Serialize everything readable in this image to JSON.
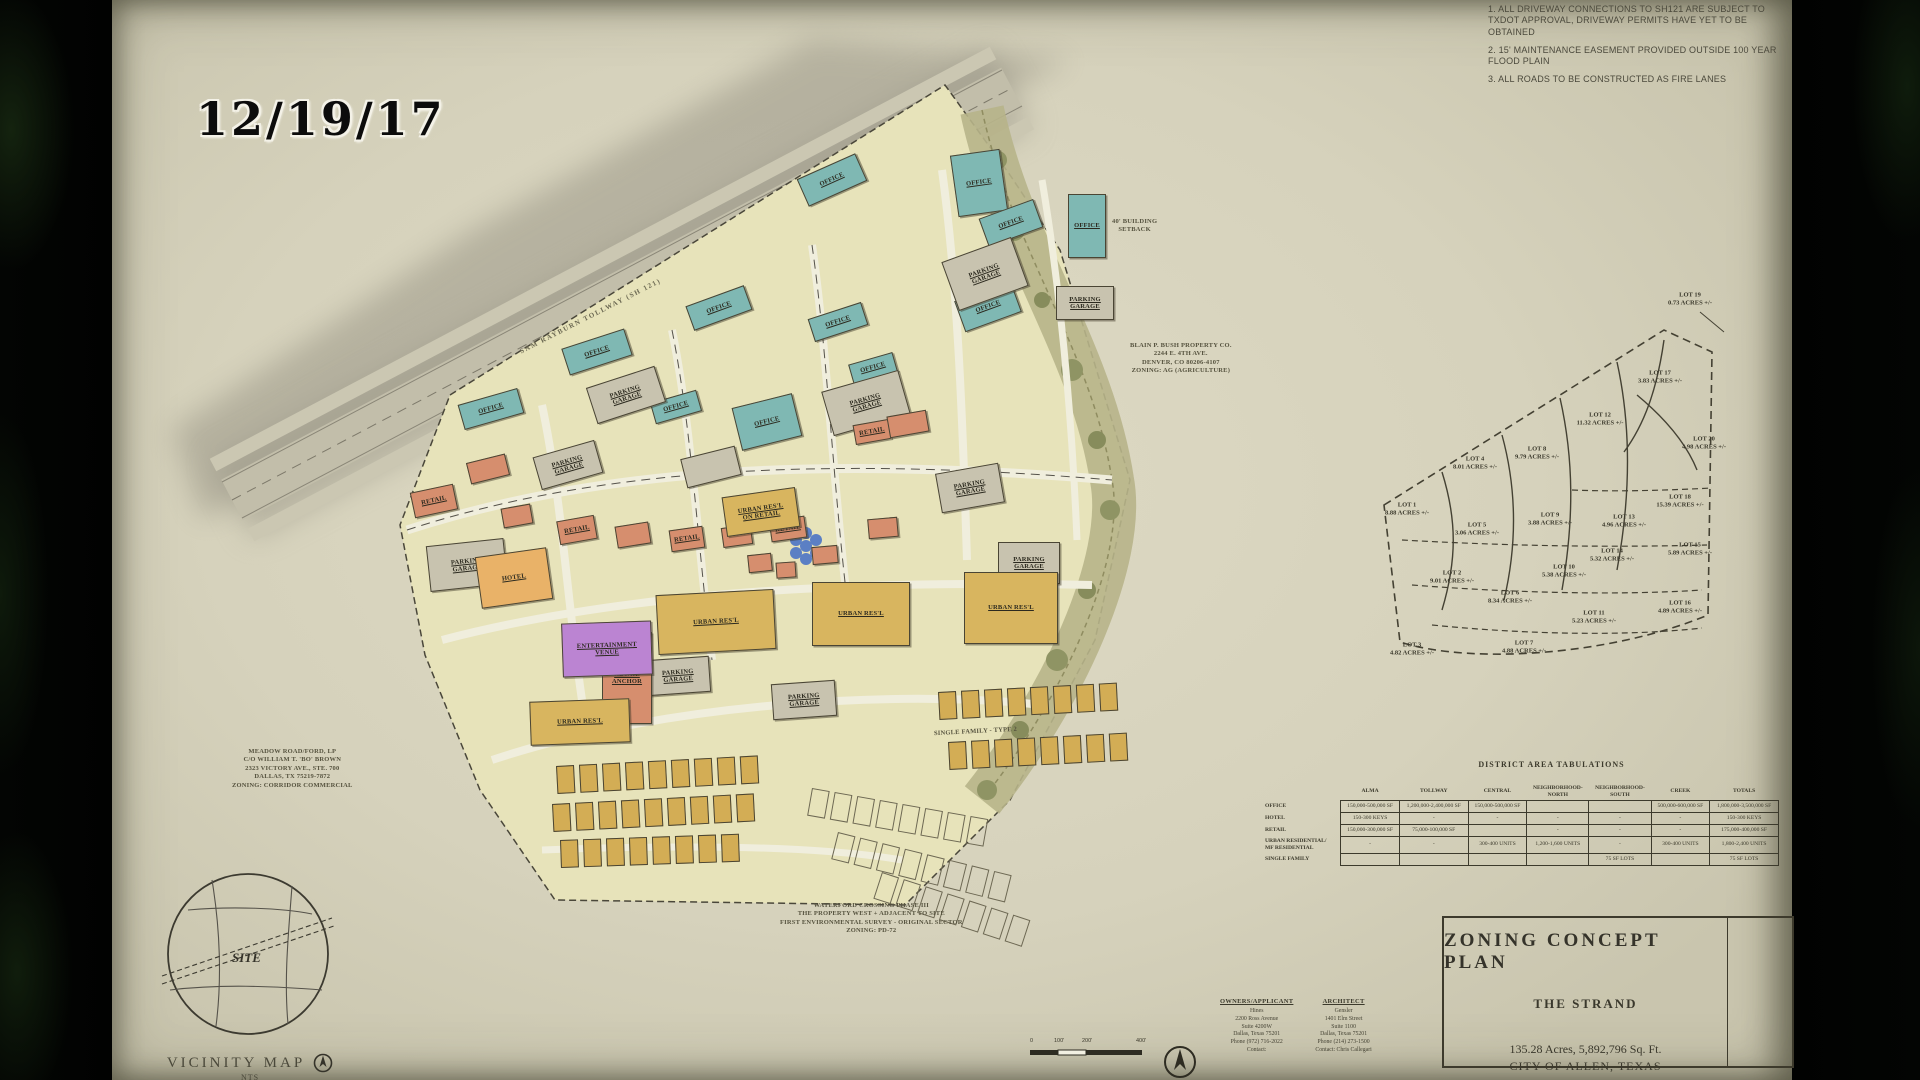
{
  "overlay": {
    "date_stamp": "12/19/17"
  },
  "notes": [
    "1.  ALL DRIVEWAY CONNECTIONS TO SH121 ARE SUBJECT TO TXDOT APPROVAL, DRIVEWAY PERMITS HAVE YET TO BE OBTAINED",
    "2.  15' MAINTENANCE EASEMENT PROVIDED OUTSIDE 100 YEAR FLOOD PLAIN",
    "3.  ALL ROADS TO BE CONSTRUCTED AS FIRE LANES"
  ],
  "title_block": {
    "line1": "ZONING CONCEPT PLAN",
    "line2": "THE STRAND",
    "line3": "135.28 Acres, 5,892,796 Sq. Ft.",
    "line4": "CITY OF ALLEN, TEXAS"
  },
  "vicinity": {
    "title": "VICINITY MAP",
    "scale": "NTS",
    "site_label": "SITE"
  },
  "scale_bar": {
    "labels": [
      "0",
      "100'",
      "200'",
      "400'"
    ],
    "ratio": "1\"=200.0'"
  },
  "contacts": {
    "owners": {
      "heading": "OWNERS/APPLICANT",
      "lines": [
        "Hines",
        "2200 Ross Avenue",
        "Suite 4200W",
        "Dallas, Texas 75201",
        "Phone (972) 716-2022",
        "Contact:"
      ]
    },
    "architect": {
      "heading": "ARCHITECT",
      "lines": [
        "Gensler",
        "1401 Elm Street",
        "Suite 1100",
        "Dallas, Texas 75201",
        "Phone (214) 273-1500",
        "Contact: Chris Callegari"
      ]
    }
  },
  "annotations": [
    {
      "id": "tollway-name",
      "text": "SAM RAYBURN TOLLWAY (SH 121)",
      "x": 400,
      "y": 312,
      "rot": -27,
      "cls": "road"
    },
    {
      "id": "setback-note",
      "text": "40' BUILDING\nSETBACK",
      "x": 1000,
      "y": 218,
      "rot": 0
    },
    {
      "id": "bush-property",
      "text": "BLAIN P. BUSH PROPERTY CO.\n2244 E. 4TH AVE.\nDENVER, CO 80206-4107\nZONING: AG (AGRICULTURE)",
      "x": 1018,
      "y": 342,
      "rot": 0
    },
    {
      "id": "meadow-property",
      "text": "MEADOW ROAD/FORD, LP\nC/O WILLIAM T. 'BO' BROWN\n2323 VICTORY AVE., STE. 700\nDALLAS, TX 75219-7872\nZONING: CORRIDOR COMMERCIAL",
      "x": 120,
      "y": 748,
      "rot": 0
    },
    {
      "id": "waterford-note",
      "text": "WATERFORD CROSSING PHASE III\nTHE PROPERTY WEST + ADJACENT TO SITE\nFIRST ENVIRONMENTAL SURVEY - ORIGINAL SECTOR\nZONING: PD-72",
      "x": 668,
      "y": 902,
      "rot": 0
    },
    {
      "id": "single-family-label",
      "text": "SINGLE FAMILY - TYPE 2",
      "x": 822,
      "y": 728,
      "rot": -3
    }
  ],
  "site": {
    "buildings": [
      {
        "x": 688,
        "y": 165,
        "w": 64,
        "h": 30,
        "r": -24,
        "label": "OFFICE",
        "type": "office"
      },
      {
        "x": 842,
        "y": 152,
        "w": 50,
        "h": 62,
        "r": -8,
        "label": "OFFICE",
        "type": "office"
      },
      {
        "x": 956,
        "y": 194,
        "w": 38,
        "h": 64,
        "r": 0,
        "label": "OFFICE",
        "type": "office"
      },
      {
        "x": 870,
        "y": 208,
        "w": 58,
        "h": 30,
        "r": -20,
        "label": "OFFICE",
        "type": "office"
      },
      {
        "x": 846,
        "y": 290,
        "w": 60,
        "h": 33,
        "r": -20,
        "label": "OFFICE",
        "type": "office"
      },
      {
        "x": 576,
        "y": 295,
        "w": 62,
        "h": 26,
        "r": -20,
        "label": "OFFICE",
        "type": "office"
      },
      {
        "x": 698,
        "y": 310,
        "w": 56,
        "h": 24,
        "r": -18,
        "label": "OFFICE",
        "type": "office"
      },
      {
        "x": 452,
        "y": 338,
        "w": 66,
        "h": 28,
        "r": -18,
        "label": "OFFICE",
        "type": "office"
      },
      {
        "x": 348,
        "y": 396,
        "w": 62,
        "h": 26,
        "r": -16,
        "label": "OFFICE",
        "type": "office"
      },
      {
        "x": 540,
        "y": 396,
        "w": 48,
        "h": 22,
        "r": -16,
        "label": "OFFICE",
        "type": "office"
      },
      {
        "x": 624,
        "y": 400,
        "w": 62,
        "h": 44,
        "r": -14,
        "label": "OFFICE",
        "type": "office"
      },
      {
        "x": 738,
        "y": 358,
        "w": 46,
        "h": 20,
        "r": -16,
        "label": "OFFICE",
        "type": "office"
      },
      {
        "x": 836,
        "y": 248,
        "w": 74,
        "h": 52,
        "r": -20,
        "label": "PARKING\nGARAGE",
        "type": "garage"
      },
      {
        "x": 944,
        "y": 286,
        "w": 58,
        "h": 34,
        "r": 0,
        "label": "PARKING\nGARAGE",
        "type": "garage"
      },
      {
        "x": 714,
        "y": 380,
        "w": 80,
        "h": 46,
        "r": -16,
        "label": "PARKING\nGARAGE",
        "type": "garage"
      },
      {
        "x": 478,
        "y": 376,
        "w": 72,
        "h": 38,
        "r": -18,
        "label": "PARKING\nGARAGE",
        "type": "garage"
      },
      {
        "x": 424,
        "y": 448,
        "w": 64,
        "h": 34,
        "r": -16,
        "label": "PARKING\nGARAGE",
        "type": "garage"
      },
      {
        "x": 316,
        "y": 542,
        "w": 78,
        "h": 46,
        "r": -6,
        "label": "PARKING\nGARAGE",
        "type": "garage"
      },
      {
        "x": 826,
        "y": 468,
        "w": 64,
        "h": 40,
        "r": -10,
        "label": "PARKING\nGARAGE",
        "type": "garage"
      },
      {
        "x": 886,
        "y": 542,
        "w": 62,
        "h": 42,
        "r": 0,
        "label": "PARKING\nGARAGE",
        "type": "garage"
      },
      {
        "x": 534,
        "y": 658,
        "w": 64,
        "h": 36,
        "r": -4,
        "label": "PARKING\nGARAGE",
        "type": "garage"
      },
      {
        "x": 660,
        "y": 682,
        "w": 64,
        "h": 36,
        "r": -4,
        "label": "PARKING\nGARAGE",
        "type": "garage"
      },
      {
        "x": 571,
        "y": 452,
        "w": 56,
        "h": 30,
        "r": -14,
        "label": "",
        "type": "garage"
      },
      {
        "x": 300,
        "y": 488,
        "w": 44,
        "h": 26,
        "r": -12,
        "label": "RETAIL",
        "type": "retail"
      },
      {
        "x": 356,
        "y": 458,
        "w": 40,
        "h": 22,
        "r": -14,
        "label": "",
        "type": "retail"
      },
      {
        "x": 390,
        "y": 506,
        "w": 30,
        "h": 20,
        "r": -10,
        "label": "",
        "type": "retail"
      },
      {
        "x": 446,
        "y": 518,
        "w": 38,
        "h": 24,
        "r": -10,
        "label": "RETAIL",
        "type": "retail"
      },
      {
        "x": 504,
        "y": 524,
        "w": 34,
        "h": 22,
        "r": -9,
        "label": "",
        "type": "retail"
      },
      {
        "x": 558,
        "y": 528,
        "w": 34,
        "h": 22,
        "r": -8,
        "label": "RETAIL",
        "type": "retail"
      },
      {
        "x": 610,
        "y": 526,
        "w": 30,
        "h": 20,
        "r": -8,
        "label": "",
        "type": "retail"
      },
      {
        "x": 658,
        "y": 518,
        "w": 36,
        "h": 22,
        "r": -8,
        "label": "RETAIL",
        "type": "retail"
      },
      {
        "x": 700,
        "y": 546,
        "w": 26,
        "h": 18,
        "r": -5,
        "label": "",
        "type": "retail"
      },
      {
        "x": 756,
        "y": 518,
        "w": 30,
        "h": 20,
        "r": -5,
        "label": "",
        "type": "retail"
      },
      {
        "x": 742,
        "y": 422,
        "w": 36,
        "h": 20,
        "r": -10,
        "label": "RETAIL",
        "type": "retail"
      },
      {
        "x": 776,
        "y": 413,
        "w": 40,
        "h": 22,
        "r": -10,
        "label": "",
        "type": "retail"
      },
      {
        "x": 636,
        "y": 554,
        "w": 24,
        "h": 18,
        "r": -6,
        "label": "",
        "type": "retail"
      },
      {
        "x": 664,
        "y": 562,
        "w": 20,
        "h": 16,
        "r": -4,
        "label": "",
        "type": "retail"
      },
      {
        "x": 612,
        "y": 492,
        "w": 74,
        "h": 40,
        "r": -8,
        "label": "URBAN RES'L\nON RETAIL",
        "type": "urban"
      },
      {
        "x": 490,
        "y": 632,
        "w": 50,
        "h": 92,
        "r": 0,
        "label": "RETAIL\nANCHOR",
        "type": "retail"
      },
      {
        "x": 366,
        "y": 552,
        "w": 72,
        "h": 52,
        "r": -8,
        "label": "HOTEL",
        "type": "hotel"
      },
      {
        "x": 450,
        "y": 622,
        "w": 90,
        "h": 54,
        "r": -2,
        "label": "ENTERTAINMENT\nVENUE",
        "type": "venue"
      },
      {
        "x": 545,
        "y": 592,
        "w": 118,
        "h": 60,
        "r": -3,
        "label": "URBAN RES'L",
        "type": "urban"
      },
      {
        "x": 700,
        "y": 582,
        "w": 98,
        "h": 64,
        "r": 0,
        "label": "URBAN RES'L",
        "type": "urban"
      },
      {
        "x": 852,
        "y": 572,
        "w": 94,
        "h": 72,
        "r": 0,
        "label": "URBAN RES'L",
        "type": "urban"
      },
      {
        "x": 418,
        "y": 700,
        "w": 100,
        "h": 44,
        "r": -2,
        "label": "URBAN RES'L",
        "type": "urban"
      }
    ],
    "sf_rows": [
      {
        "x": 826,
        "y": 692,
        "n": 8,
        "r": -3,
        "type": "sf"
      },
      {
        "x": 836,
        "y": 742,
        "n": 8,
        "r": -3,
        "type": "sf"
      },
      {
        "x": 444,
        "y": 766,
        "n": 9,
        "r": -3,
        "type": "sf"
      },
      {
        "x": 440,
        "y": 804,
        "n": 9,
        "r": -3,
        "type": "sf"
      },
      {
        "x": 448,
        "y": 840,
        "n": 8,
        "r": -2,
        "type": "sf"
      },
      {
        "x": 700,
        "y": 788,
        "n": 8,
        "r": 10,
        "type": "lot"
      },
      {
        "x": 726,
        "y": 832,
        "n": 8,
        "r": 14,
        "type": "lot"
      },
      {
        "x": 770,
        "y": 872,
        "n": 7,
        "r": 18,
        "type": "lot"
      }
    ]
  },
  "lot_diagram": {
    "lots": [
      {
        "name": "LOT 19",
        "acres": "0.73 ACRES +/-",
        "x": 1578,
        "y": 300
      },
      {
        "name": "LOT 17",
        "acres": "3.83 ACRES +/-",
        "x": 1548,
        "y": 378
      },
      {
        "name": "LOT 12",
        "acres": "11.32 ACRES +/-",
        "x": 1488,
        "y": 420
      },
      {
        "name": "LOT 20",
        "acres": "4.98 ACRES +/-",
        "x": 1592,
        "y": 444
      },
      {
        "name": "LOT 8",
        "acres": "9.79 ACRES +/-",
        "x": 1425,
        "y": 454
      },
      {
        "name": "LOT 4",
        "acres": "8.01 ACRES +/-",
        "x": 1363,
        "y": 464
      },
      {
        "name": "LOT 18",
        "acres": "15.39 ACRES +/-",
        "x": 1568,
        "y": 502
      },
      {
        "name": "LOT 1",
        "acres": "8.88 ACRES +/-",
        "x": 1295,
        "y": 510
      },
      {
        "name": "LOT 5",
        "acres": "3.06 ACRES +/-",
        "x": 1365,
        "y": 530
      },
      {
        "name": "LOT 9",
        "acres": "3.88 ACRES +/-",
        "x": 1438,
        "y": 520
      },
      {
        "name": "LOT 13",
        "acres": "4.96 ACRES +/-",
        "x": 1512,
        "y": 522
      },
      {
        "name": "LOT 14",
        "acres": "5.32 ACRES +/-",
        "x": 1500,
        "y": 556
      },
      {
        "name": "LOT 15",
        "acres": "5.89 ACRES +/-",
        "x": 1578,
        "y": 550
      },
      {
        "name": "LOT 2",
        "acres": "9.01 ACRES +/-",
        "x": 1340,
        "y": 578
      },
      {
        "name": "LOT 6",
        "acres": "8.34 ACRES +/-",
        "x": 1398,
        "y": 598
      },
      {
        "name": "LOT 10",
        "acres": "5.38 ACRES +/-",
        "x": 1452,
        "y": 572
      },
      {
        "name": "LOT 11",
        "acres": "5.23 ACRES +/-",
        "x": 1482,
        "y": 618
      },
      {
        "name": "LOT 16",
        "acres": "4.89 ACRES +/-",
        "x": 1568,
        "y": 608
      },
      {
        "name": "LOT 3",
        "acres": "4.82 ACRES +/-",
        "x": 1300,
        "y": 650
      },
      {
        "name": "LOT 7",
        "acres": "4.88 ACRES +/-",
        "x": 1412,
        "y": 648
      }
    ]
  },
  "table": {
    "title": "DISTRICT AREA TABULATIONS",
    "columns": [
      "",
      "ALMA",
      "TOLLWAY",
      "CENTRAL",
      "NEIGHBORHOOD-\nNORTH",
      "NEIGHBORHOOD-\nSOUTH",
      "CREEK",
      "TOTALS"
    ],
    "rows": [
      {
        "label": "OFFICE",
        "cells": [
          "150,000-500,000 SF",
          "1,200,000-2,400,000 SF",
          "150,000-500,000 SF",
          "",
          "",
          "500,000-600,000 SF",
          "1,800,000-3,500,000 SF"
        ]
      },
      {
        "label": "HOTEL",
        "cells": [
          "150-300 KEYS",
          "-",
          "-",
          "-",
          "-",
          "-",
          "150-300 KEYS"
        ]
      },
      {
        "label": "RETAIL",
        "cells": [
          "150,000-300,000 SF",
          "75,000-100,000 SF",
          "",
          "-",
          "-",
          "-",
          "175,000-400,000 SF"
        ]
      },
      {
        "label": "URBAN RESIDENTIAL/\nMF RESIDENTIAL",
        "cells": [
          "-",
          "-",
          "300-400 UNITS",
          "1,200-1,600 UNITS",
          "-",
          "300-400 UNITS",
          "1,800-2,400 UNITS"
        ]
      },
      {
        "label": "SINGLE FAMILY",
        "cells": [
          "",
          "",
          "",
          "",
          "75 SF LOTS",
          "",
          "75 SF LOTS"
        ]
      }
    ]
  },
  "colors": {
    "office": "#7fb8b3",
    "garage": "#c8c3af",
    "retail": "#d68e6e",
    "hotel": "#e9b268",
    "venue": "#bb84d2",
    "urban_residential": "#d8b55f",
    "creek": "#b7b489",
    "paper": "#d6d2bc"
  }
}
